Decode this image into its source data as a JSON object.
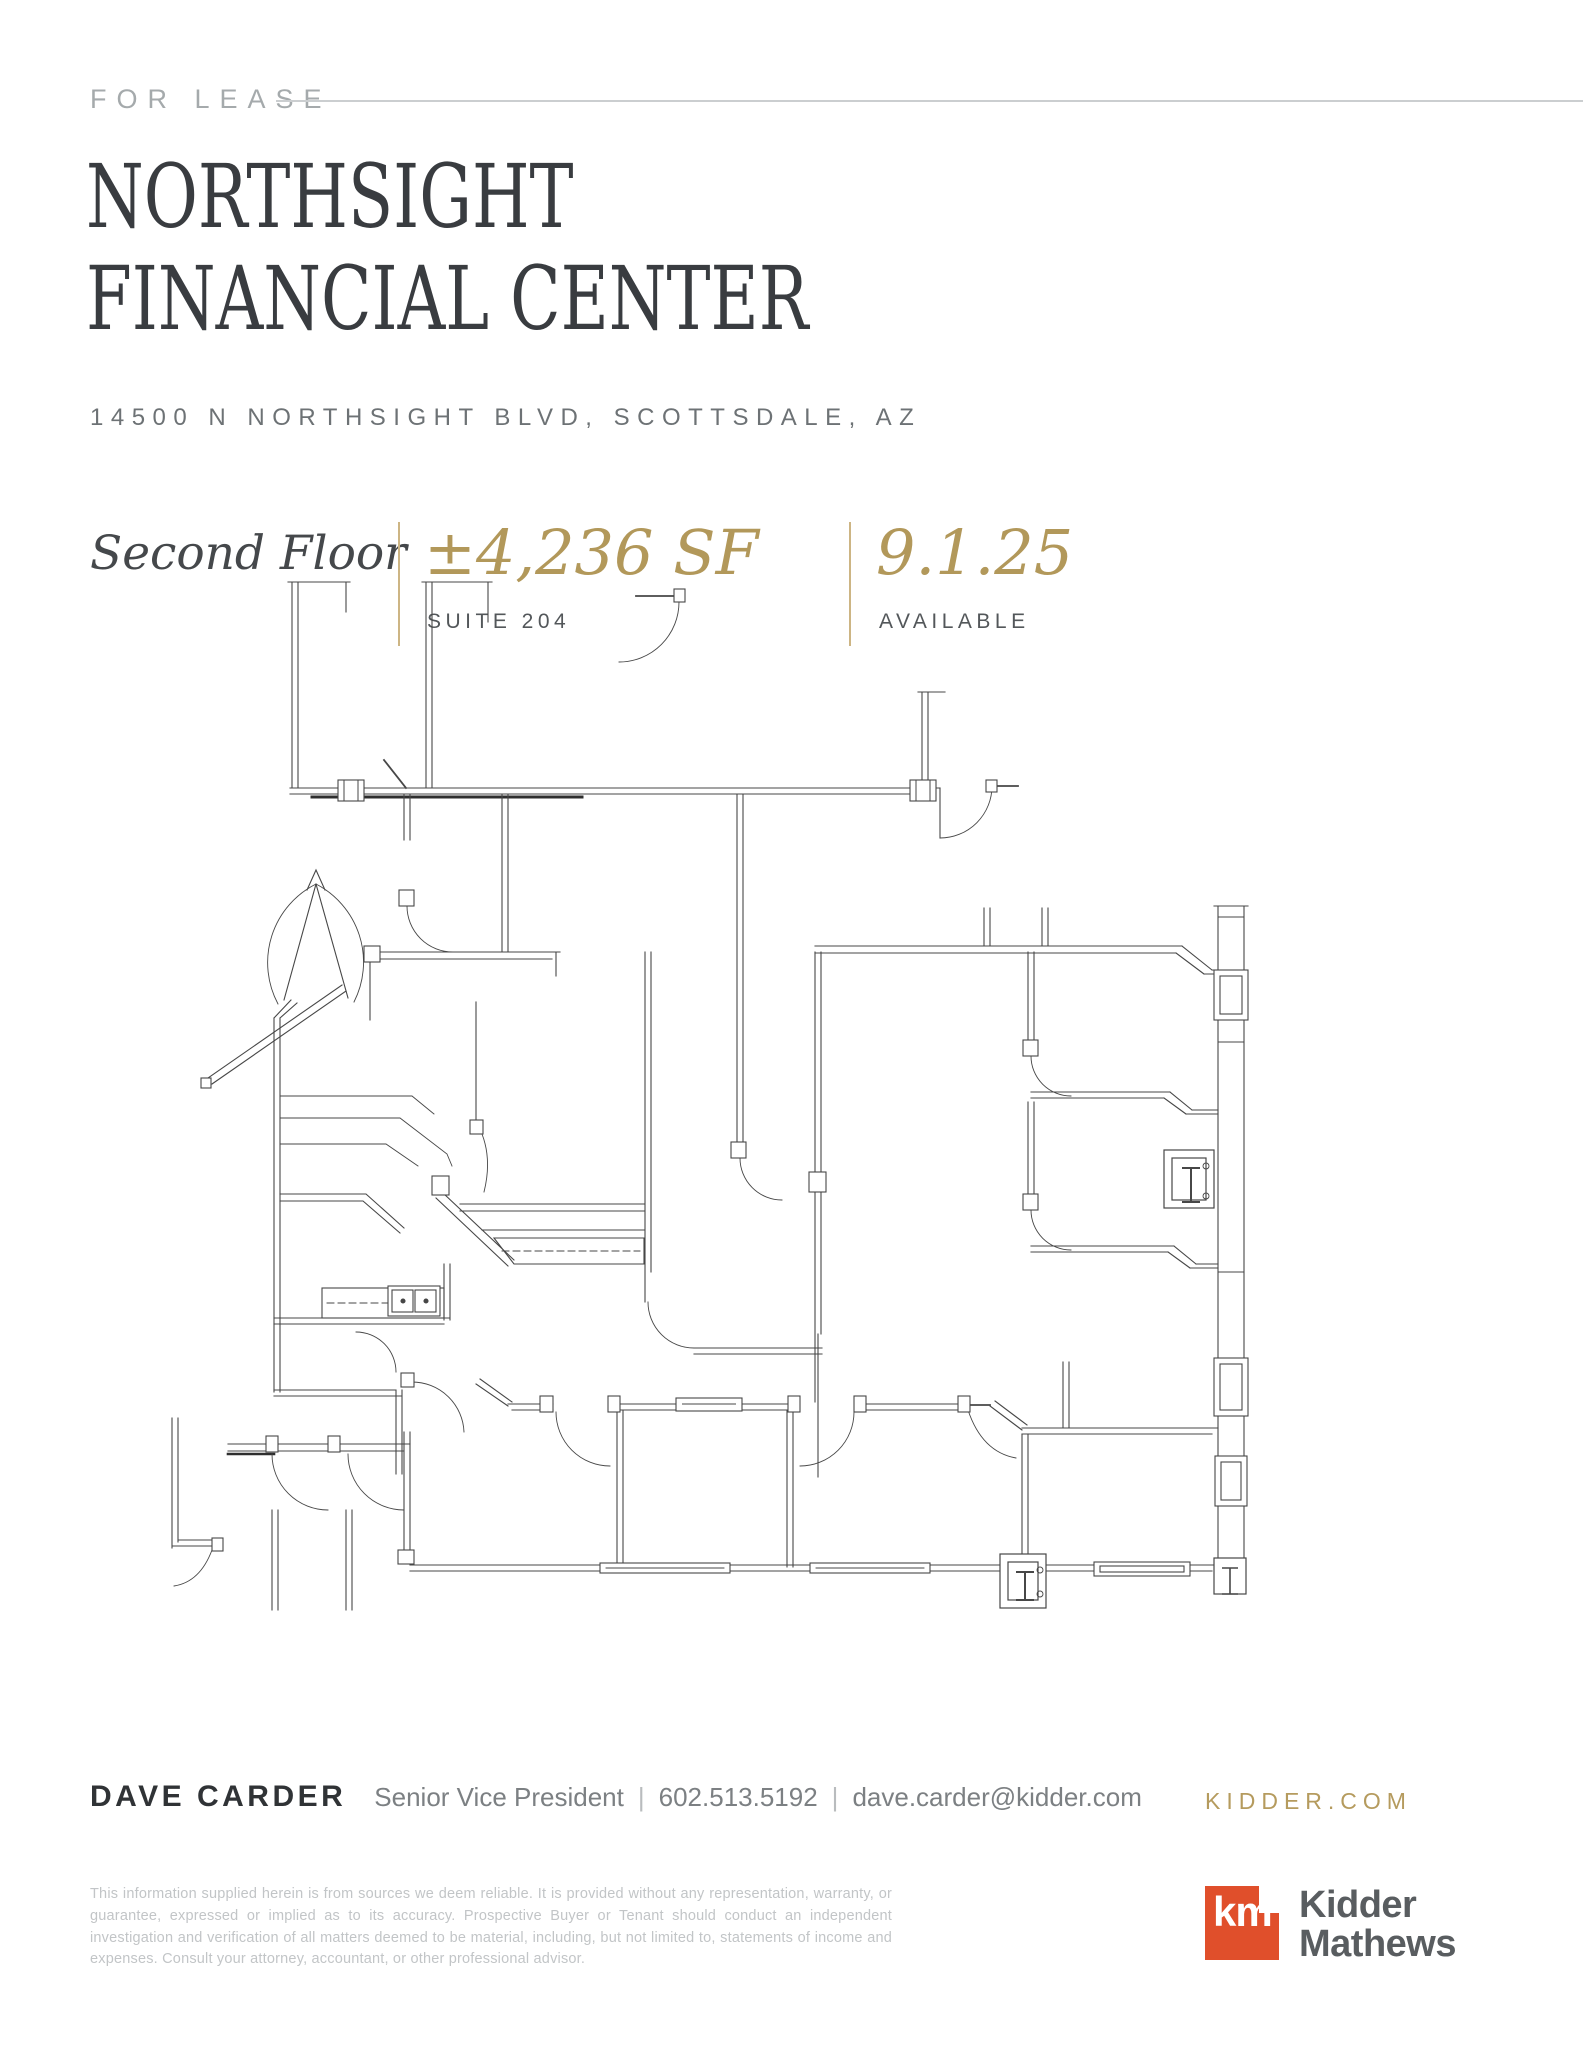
{
  "page": {
    "eyebrow": "FOR LEASE",
    "title_line1": "NORTHSIGHT",
    "title_line2": "FINANCIAL CENTER",
    "address": "14500 N NORTHSIGHT BLVD, SCOTTSDALE, AZ"
  },
  "details": {
    "floor_label": "Second Floor",
    "stats": [
      {
        "value": "±4,236 SF",
        "label": "SUITE 204"
      },
      {
        "value": "9.1.25",
        "label": "AVAILABLE"
      }
    ]
  },
  "contact": {
    "name": "DAVE CARDER",
    "title": "Senior Vice President",
    "phone": "602.513.5192",
    "email": "dave.carder@kidder.com",
    "divider": "|",
    "website": "KIDDER.COM"
  },
  "legal": {
    "disclaimer": "This information supplied herein is from sources we deem reliable. It is provided without any representation, warranty, or guarantee, expressed or implied as to its accuracy. Prospective Buyer or Tenant should conduct an independent investigation and verification of all matters deemed to be material, including, but not limited to, statements of income and expenses. Consult your attorney, accountant, or other professional advisor."
  },
  "brand": {
    "logo_mark": "km",
    "logo_name_line1": "Kidder",
    "logo_name_line2": "Mathews",
    "brand_red": "#e04f2b",
    "accent_gold": "#b2985a",
    "ink": "#393c40"
  }
}
